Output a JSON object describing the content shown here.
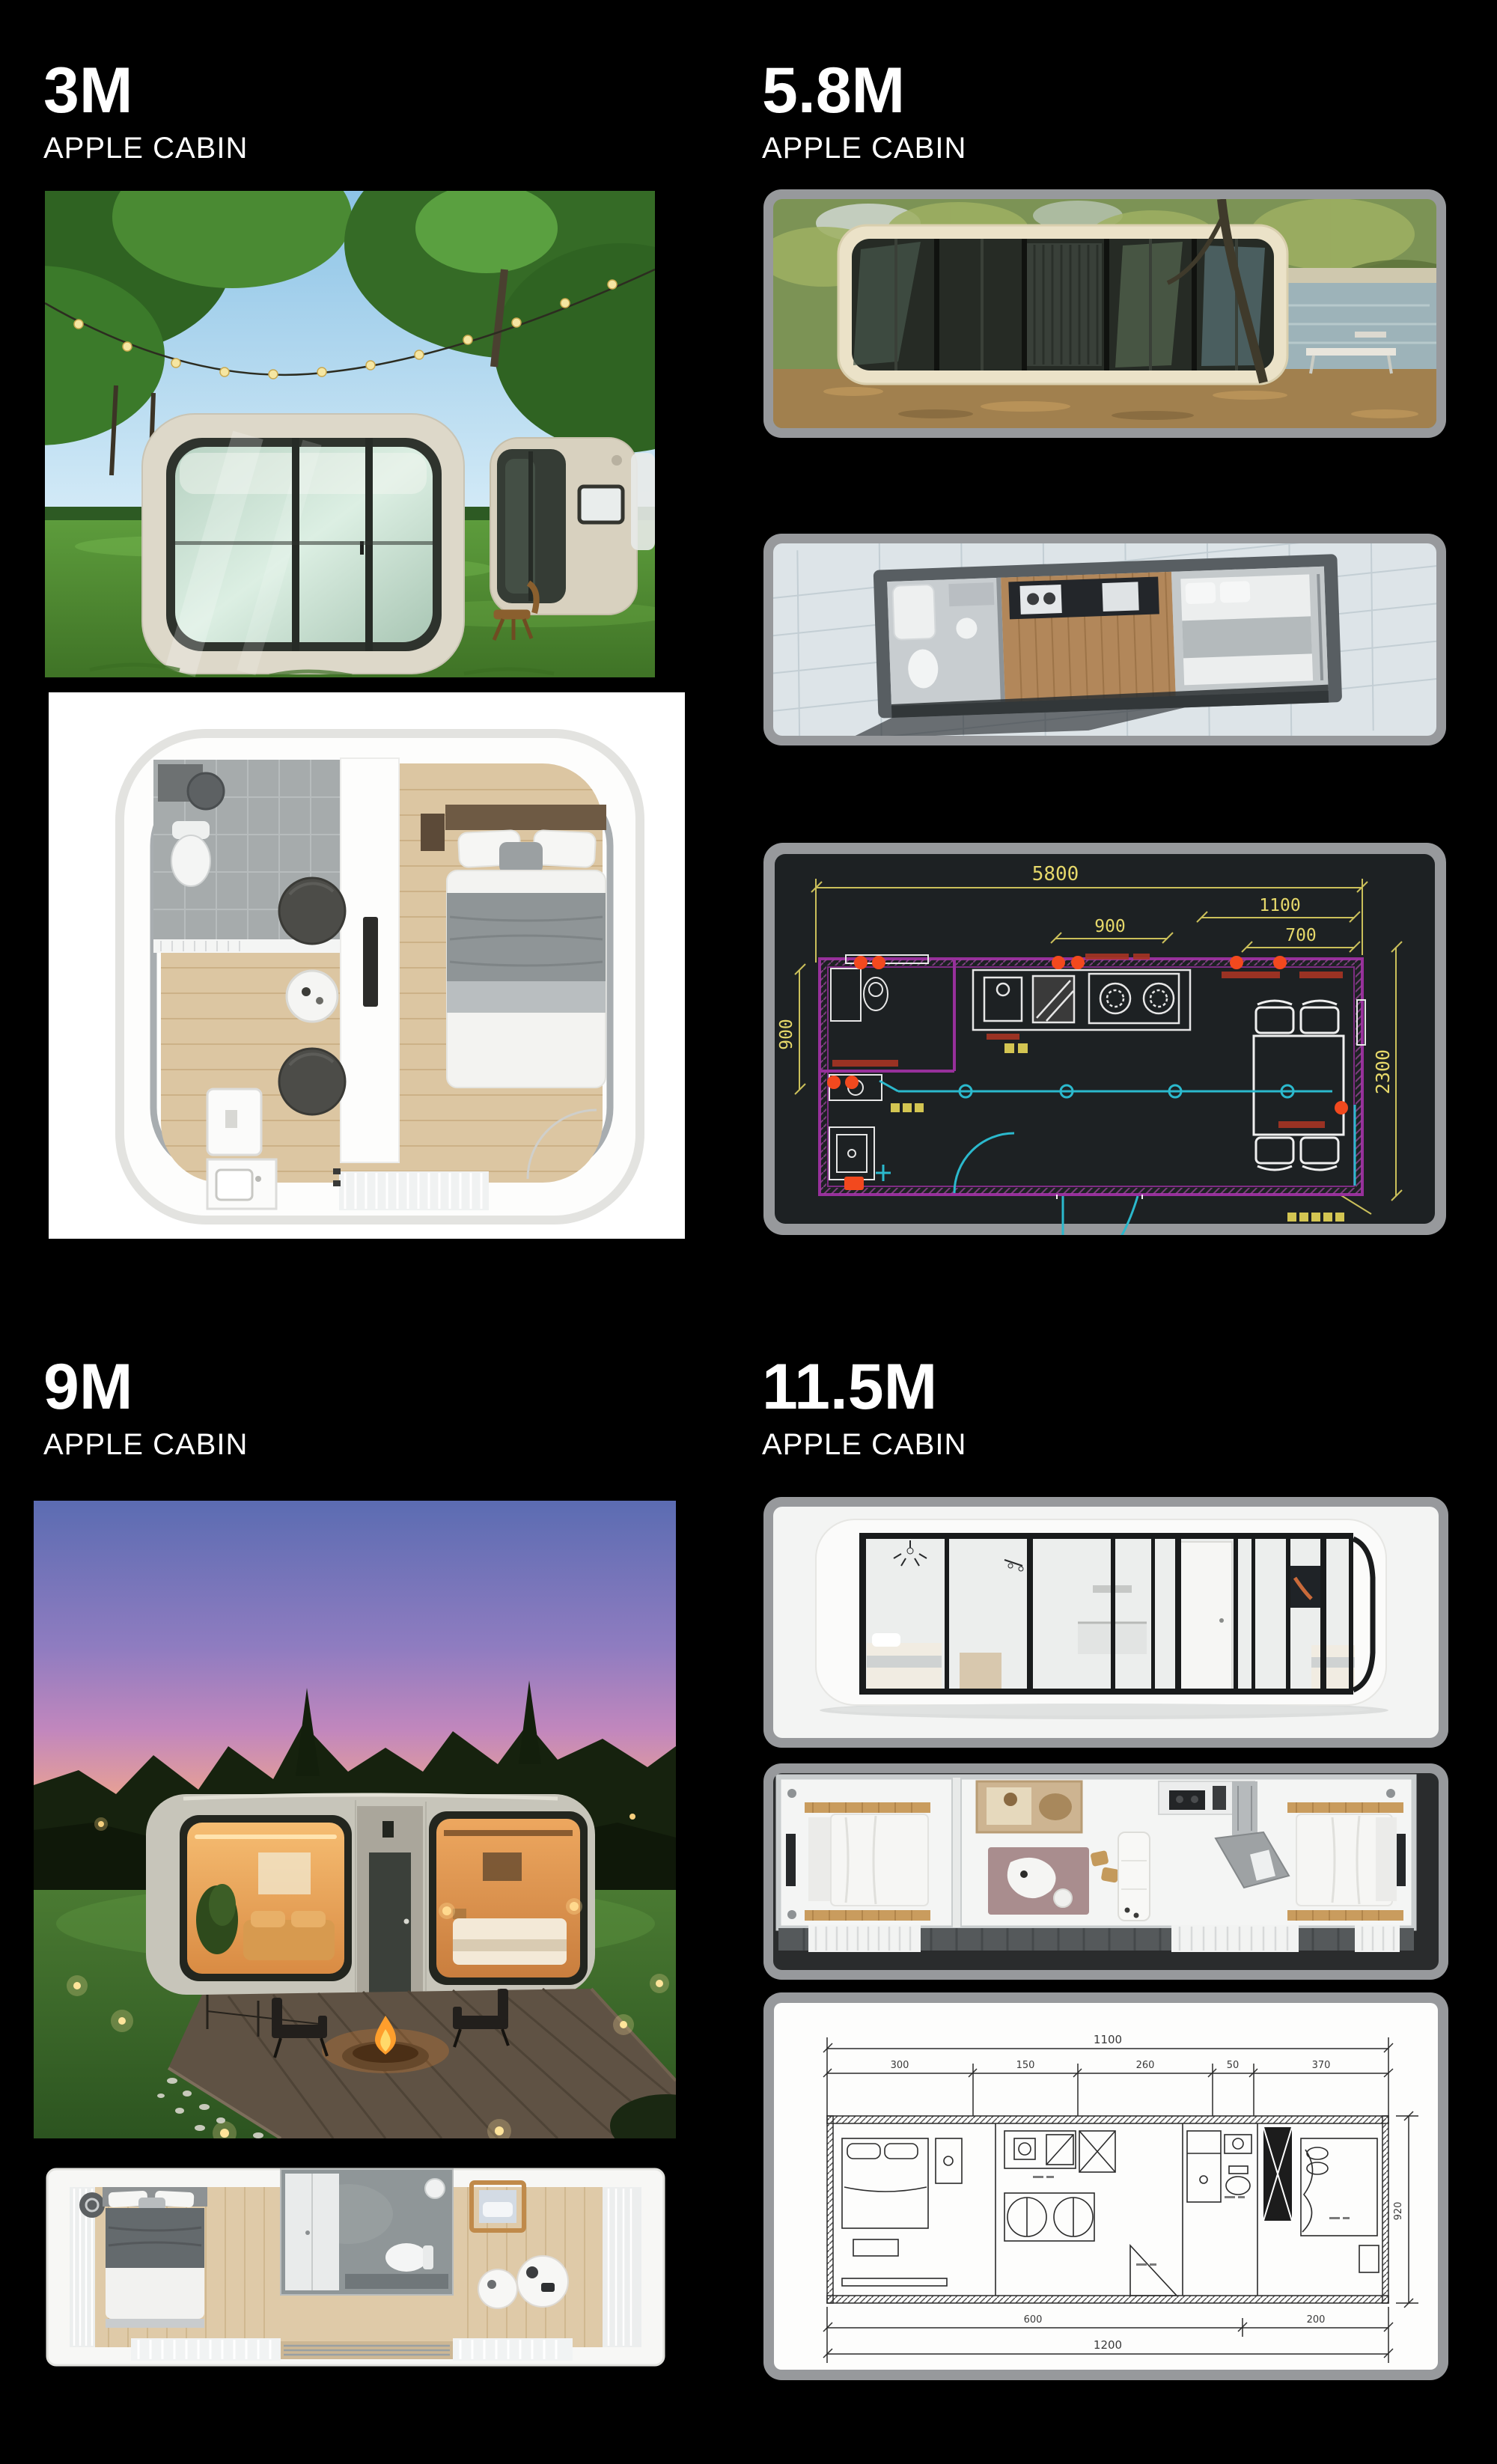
{
  "page": {
    "background": "#000000",
    "heading_color": "#ffffff",
    "image_frame_color": "#97999c"
  },
  "sections": [
    {
      "title": "3M",
      "subtitle": "APPLE CABIN"
    },
    {
      "title": "5.8M",
      "subtitle": "APPLE CABIN"
    },
    {
      "title": "9M",
      "subtitle": "APPLE CABIN"
    },
    {
      "title": "11.5M",
      "subtitle": "APPLE CABIN"
    }
  ],
  "cad_5_8m": {
    "dim_top_total": "5800",
    "dim_top_right_upper": "1100",
    "dim_top_right_lower": "700",
    "dim_top_mid": "900",
    "dim_left_height": "900",
    "dim_right_height": "2300",
    "colors": {
      "background": "#1d2123",
      "walls": "#97309b",
      "lines": "#2bb9cd",
      "dimensions": "#e6d86a",
      "markers": "#f2491e",
      "annotations": "#a83424"
    }
  },
  "blueprint_11_5m": {
    "dim_top_total": "1100",
    "dim_segments": [
      "300",
      "150",
      "260",
      "50",
      "370"
    ],
    "dim_bottom_left": "600",
    "dim_bottom_right": "200",
    "dim_bottom_total": "1200",
    "dim_right_height": "920"
  }
}
